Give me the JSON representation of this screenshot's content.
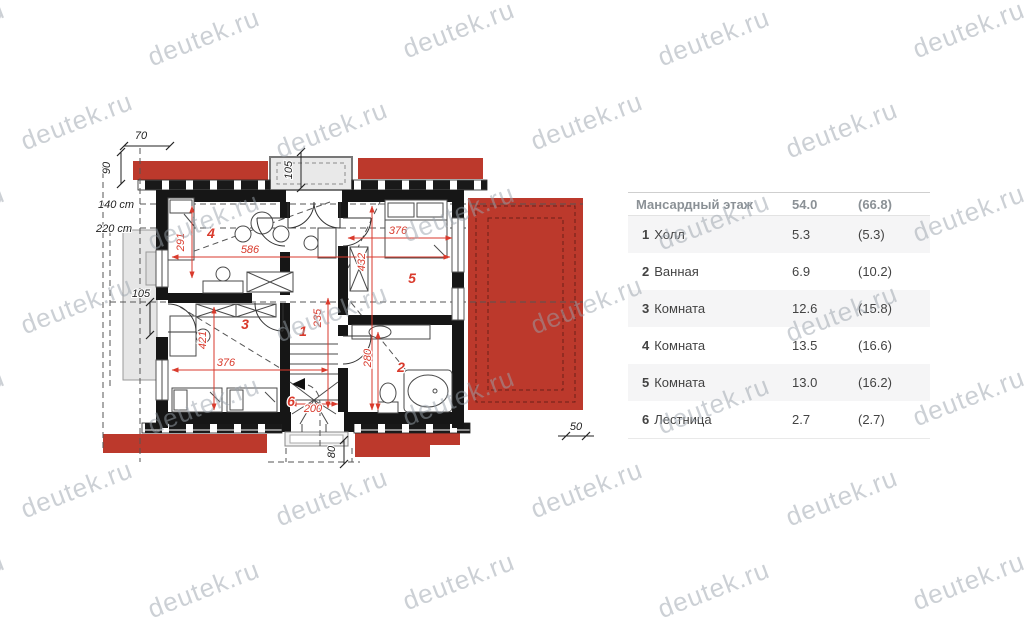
{
  "watermark": {
    "text": "deutek.ru"
  },
  "legend_table": {
    "header": {
      "title": "Мансардный этаж",
      "area": "54.0",
      "total": "(66.8)"
    },
    "rows": [
      {
        "num": "1",
        "name": "Холл",
        "area": "5.3",
        "total": "(5.3)"
      },
      {
        "num": "2",
        "name": "Ванная",
        "area": "6.9",
        "total": "(10.2)"
      },
      {
        "num": "3",
        "name": "Комната",
        "area": "12.6",
        "total": "(15.8)"
      },
      {
        "num": "4",
        "name": "Комната",
        "area": "13.5",
        "total": "(16.6)"
      },
      {
        "num": "5",
        "name": "Комната",
        "area": "13.0",
        "total": "(16.2)"
      },
      {
        "num": "6",
        "name": "Лестница",
        "area": "2.7",
        "total": "(2.7)"
      }
    ]
  },
  "plan": {
    "rooms": {
      "r1": "1",
      "r2": "2",
      "r3": "3",
      "r4": "4",
      "r5": "5",
      "r6": "6"
    },
    "dims_red": {
      "d291": "291",
      "d586": "586",
      "d376_top": "376",
      "d432": "432",
      "d235": "235",
      "d421": "421",
      "d376_bottom": "376",
      "d280": "280",
      "d200": "200"
    },
    "dims_black": {
      "d70": "70",
      "d90": "90",
      "d105_dormer": "105",
      "d105_left": "105",
      "d140": "140 cm",
      "d220": "220 cm",
      "d50": "50",
      "d80": "80"
    },
    "colors": {
      "roof_red": "#bc392c",
      "dim_red": "#d93a2c",
      "wall": "#161616"
    }
  }
}
